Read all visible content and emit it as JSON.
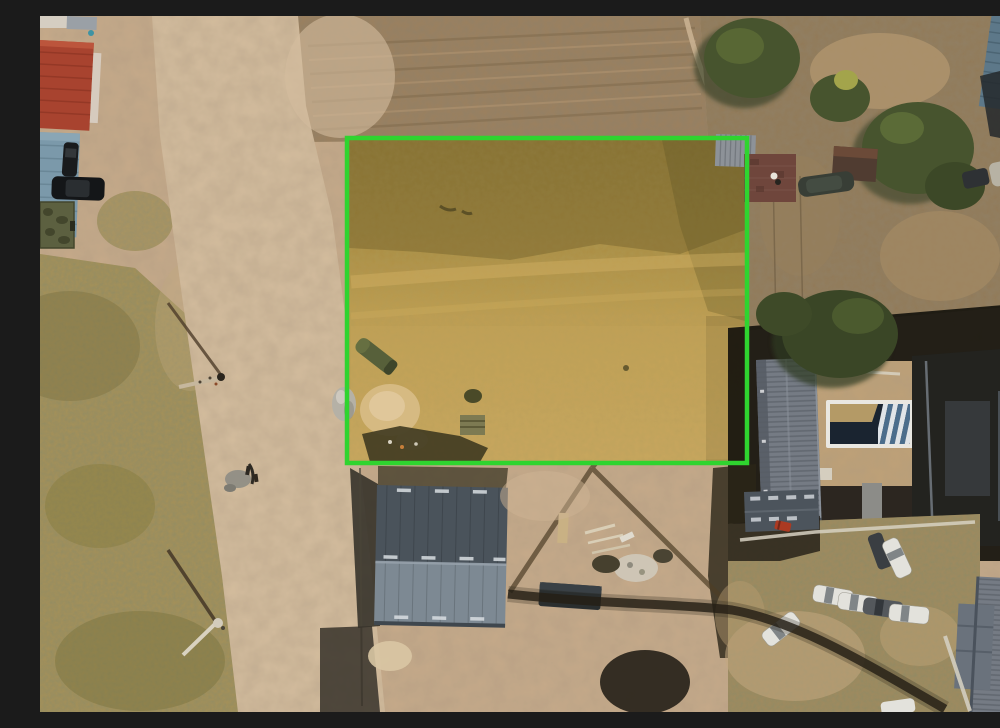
{
  "meta": {
    "title": "Aerial drone photo of a highlighted vacant land plot",
    "domain": "aerial-photograph",
    "visible_text": []
  },
  "scene": {
    "description": "Top-down drone photograph of a dusty suburban area; a vacant rectangular land plot is outlined with a bright green boundary and shaded gold; a dirt road runs along the left, houses with gray roofs, a pool and parked white cars are on the right, and a gray gable-roof building sits below the plot.",
    "plot": {
      "label": "highlighted-land-plot",
      "x": 307,
      "y": 122,
      "width": 400,
      "height": 325
    },
    "palette": {
      "plot-border": "#2fd42f",
      "gold-top": "#97803a",
      "gold-low": "#c6a55c",
      "ground": "#c6aa8a",
      "road": "#d4bd9e",
      "grass": "#a69158",
      "scrub": "#9b805f",
      "scrub-right": "#927a58",
      "shadow": "#17140e",
      "tree": "#47542e",
      "tree-dark": "#2f3a20",
      "roof-red": "#a8432f",
      "roof-blue": "#7b99aa",
      "roof-blue-tr": "#5d7889",
      "roof-slate": "#4a535b",
      "roof-gray": "#7d8993",
      "roof-long": "#757b84",
      "roof-dark": "#23231f",
      "shed-maroon": "#6f463c",
      "shed-gray": "#8d9298",
      "pool-frame": "#e9e7e1",
      "pool-water": "#1a2430",
      "pool-cover": "#b49a66",
      "pool-stripe": "#4a6d8c",
      "car-white": "#e3e2dc",
      "car-dark": "#26292c",
      "sand": "#d6ba82",
      "tank-green": "#57603a",
      "trailer-green": "#5c6040",
      "debris": "#3f3a20",
      "fence-shadow": "#241f15",
      "parking": "#a18a5e"
    },
    "objects": [
      "green plot boundary",
      "gold plot overlay",
      "dirt road",
      "dry grass field",
      "red tile roof house",
      "blue roof shed",
      "black cars",
      "camo trailer",
      "trees",
      "corrugated shed",
      "brick shed",
      "long gray ribbed roof house",
      "swimming pool with cover and stripes",
      "dark shadowed house",
      "gable roof warehouse",
      "construction debris",
      "white parked cars",
      "fence shadow",
      "utility pole shadows",
      "white dome tank",
      "sand pile"
    ]
  }
}
